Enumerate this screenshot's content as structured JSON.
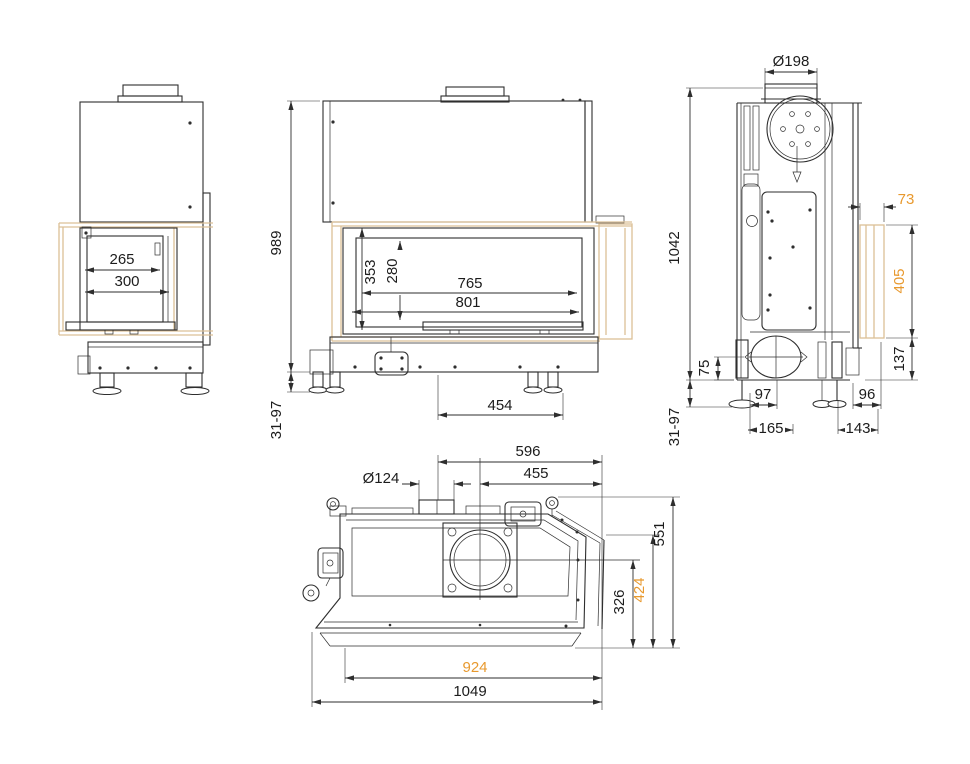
{
  "colors": {
    "line": "#2e2e2e",
    "accent_text": "#e8992e",
    "glass_highlight": "#dcc096",
    "background": "#ffffff"
  },
  "views": {
    "left_side": {
      "dims": {
        "glass_inner_depth": "265",
        "door_depth": "300"
      }
    },
    "front": {
      "dims": {
        "body_height": "989",
        "leg_adjust_range": "31-97",
        "glass_outer_height": "353",
        "glass_inner_height": "280",
        "glass_inner_width": "765",
        "glass_outer_width": "801",
        "leg_spacing": "454"
      }
    },
    "right_side": {
      "dims": {
        "flue_diameter": "Ø198",
        "total_height": "1042",
        "leg_adjust_range": "31-97",
        "corner_glass_depth": "73",
        "corner_glass_height": "405",
        "corner_glass_bottom_offset": "137",
        "intake_offset": "75",
        "intake_center": "97",
        "front_leg_span": "165",
        "rear_offset": "96",
        "rear_leg_span": "143"
      }
    },
    "top": {
      "dims": {
        "intake_center_to_edge": "596",
        "flue_center_to_edge": "455",
        "intake_diameter": "Ø124",
        "total_depth": "551",
        "glass_depth": "424",
        "firebox_depth": "326",
        "glass_width": "924",
        "total_width": "1049"
      }
    }
  }
}
